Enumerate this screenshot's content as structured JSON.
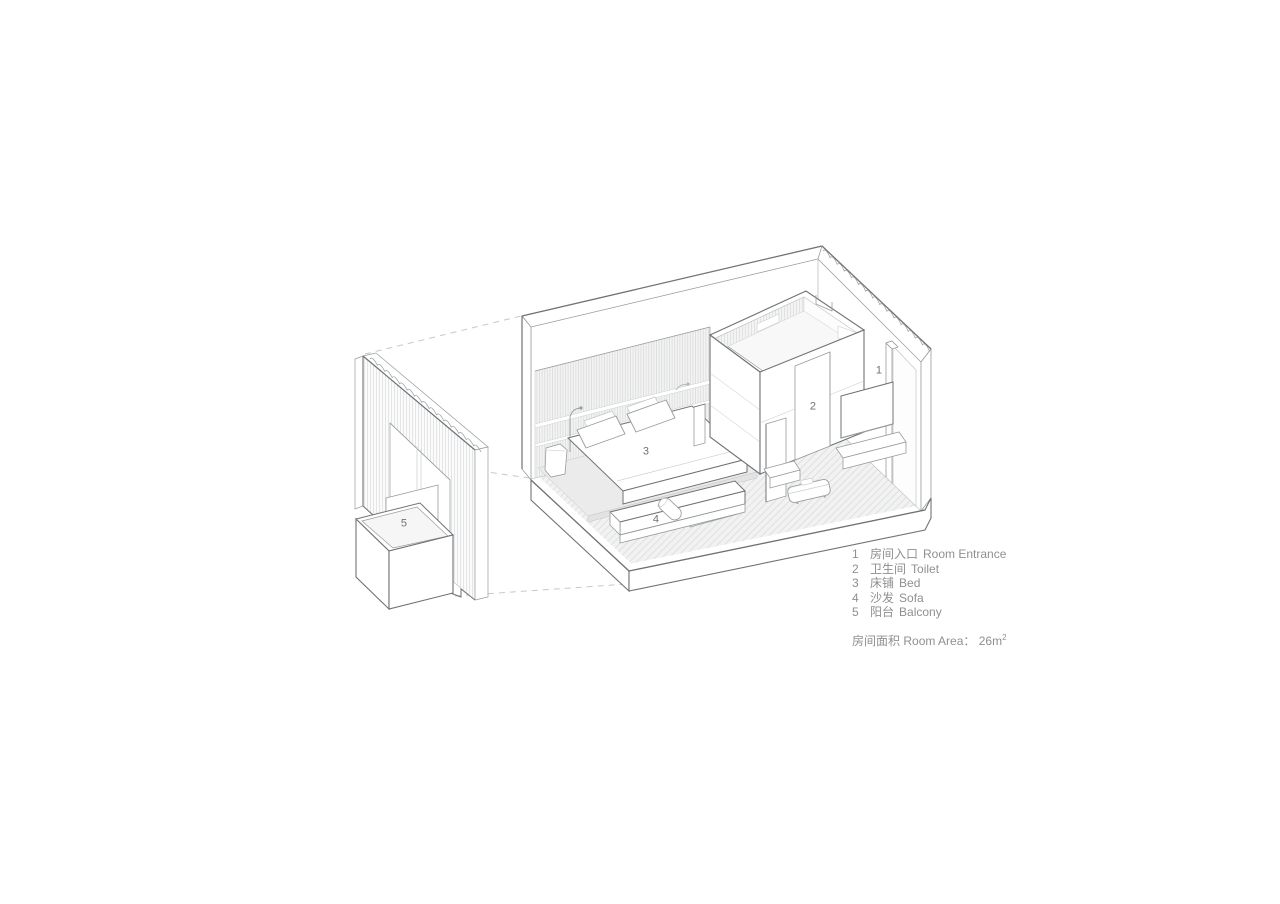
{
  "legend": {
    "items": [
      {
        "num": "1",
        "zh": "房间入口",
        "en": "Room Entrance"
      },
      {
        "num": "2",
        "zh": "卫生间",
        "en": "Toilet"
      },
      {
        "num": "3",
        "zh": "床铺",
        "en": "Bed"
      },
      {
        "num": "4",
        "zh": "沙发",
        "en": "Sofa"
      },
      {
        "num": "5",
        "zh": "阳台",
        "en": "Balcony"
      }
    ],
    "area_note": {
      "zh": "房间面积",
      "en": "Room Area",
      "colon": "：",
      "value": "26m",
      "sup": "2"
    }
  },
  "colors": {
    "line_strong": "#6f7376",
    "line_mid": "#989c9e",
    "line_light": "#c2c5c7",
    "hatch": "#d5d7d9",
    "floor_fill": "#f2f2f2",
    "text_gray": "#8d9092"
  }
}
